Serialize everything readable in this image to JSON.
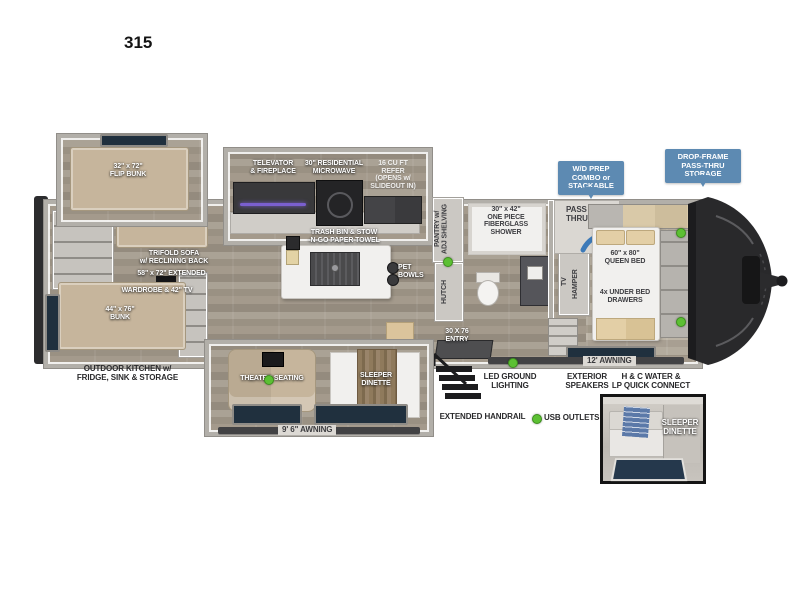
{
  "model_number": "315",
  "callouts": {
    "wd_prep": "W/D PREP\nCOMBO or\nSTACKABLE",
    "drop_frame": "DROP-FRAME\nPASS-THRU\nSTORAGE"
  },
  "labels": {
    "flip_bunk": "32\" x 72\"\nFLIP BUNK",
    "trifold_sofa": "TRIFOLD SOFA\nw/ RECLINING BACK",
    "trifold_sofa_size": "58\" x 72\" EXTENDED",
    "wardrobe_tv": "WARDROBE & 42\" TV",
    "bunk": "44\" x 76\"\nBUNK",
    "outdoor_kitchen": "OUTDOOR KITCHEN w/\nFRIDGE, SINK & STORAGE",
    "televator": "TELEVATOR\n& FIREPLACE",
    "microwave": "30\" RESIDENTIAL\nMICROWAVE",
    "refrigerator": "16 CU FT\nREFER\n(OPENS w/\nSLIDEOUT IN)",
    "trash_bin": "TRASH BIN & STOW\n-N-GO PAPER TOWEL",
    "pet_bowls": "PET\nBOWLS",
    "pantry": "PANTRY w/\nADJ SHELVING",
    "hutch": "HUTCH",
    "shower": "30\" x 42\"\nONE PIECE\nFIBERGLASS\nSHOWER",
    "pass_thru": "PASS\nTHRU",
    "tv": "TV",
    "hamper": "HAMPER",
    "queen_bed": "60\" x 80\"\nQUEEN BED",
    "under_bed": "4x UNDER BED\nDRAWERS",
    "ottoman": "OTTOMAN",
    "theater_seating": "THEATER SEATING",
    "sleeper_dinette": "SLEEPER\nDINETTE",
    "entry": "30 X 76\nENTRY",
    "awning_main": "9' 6\" AWNING",
    "awning_front": "12' AWNING",
    "led_lighting": "LED GROUND\nLIGHTING",
    "exterior_speakers": "EXTERIOR\nSPEAKERS",
    "water_connect": "H & C WATER &\nLP QUICK CONNECT",
    "extended_handrail": "EXTENDED HANDRAIL",
    "usb_outlets": "USB OUTLETS",
    "inset_caption": "SLEEPER\nDINETTE"
  },
  "colors": {
    "callout_blue": "#5d8ab2",
    "usb_green": "#5cc033",
    "window_navy": "#20303e",
    "front_cap": "#29292b",
    "accent_arrow_blue": "#3d7ab8"
  }
}
